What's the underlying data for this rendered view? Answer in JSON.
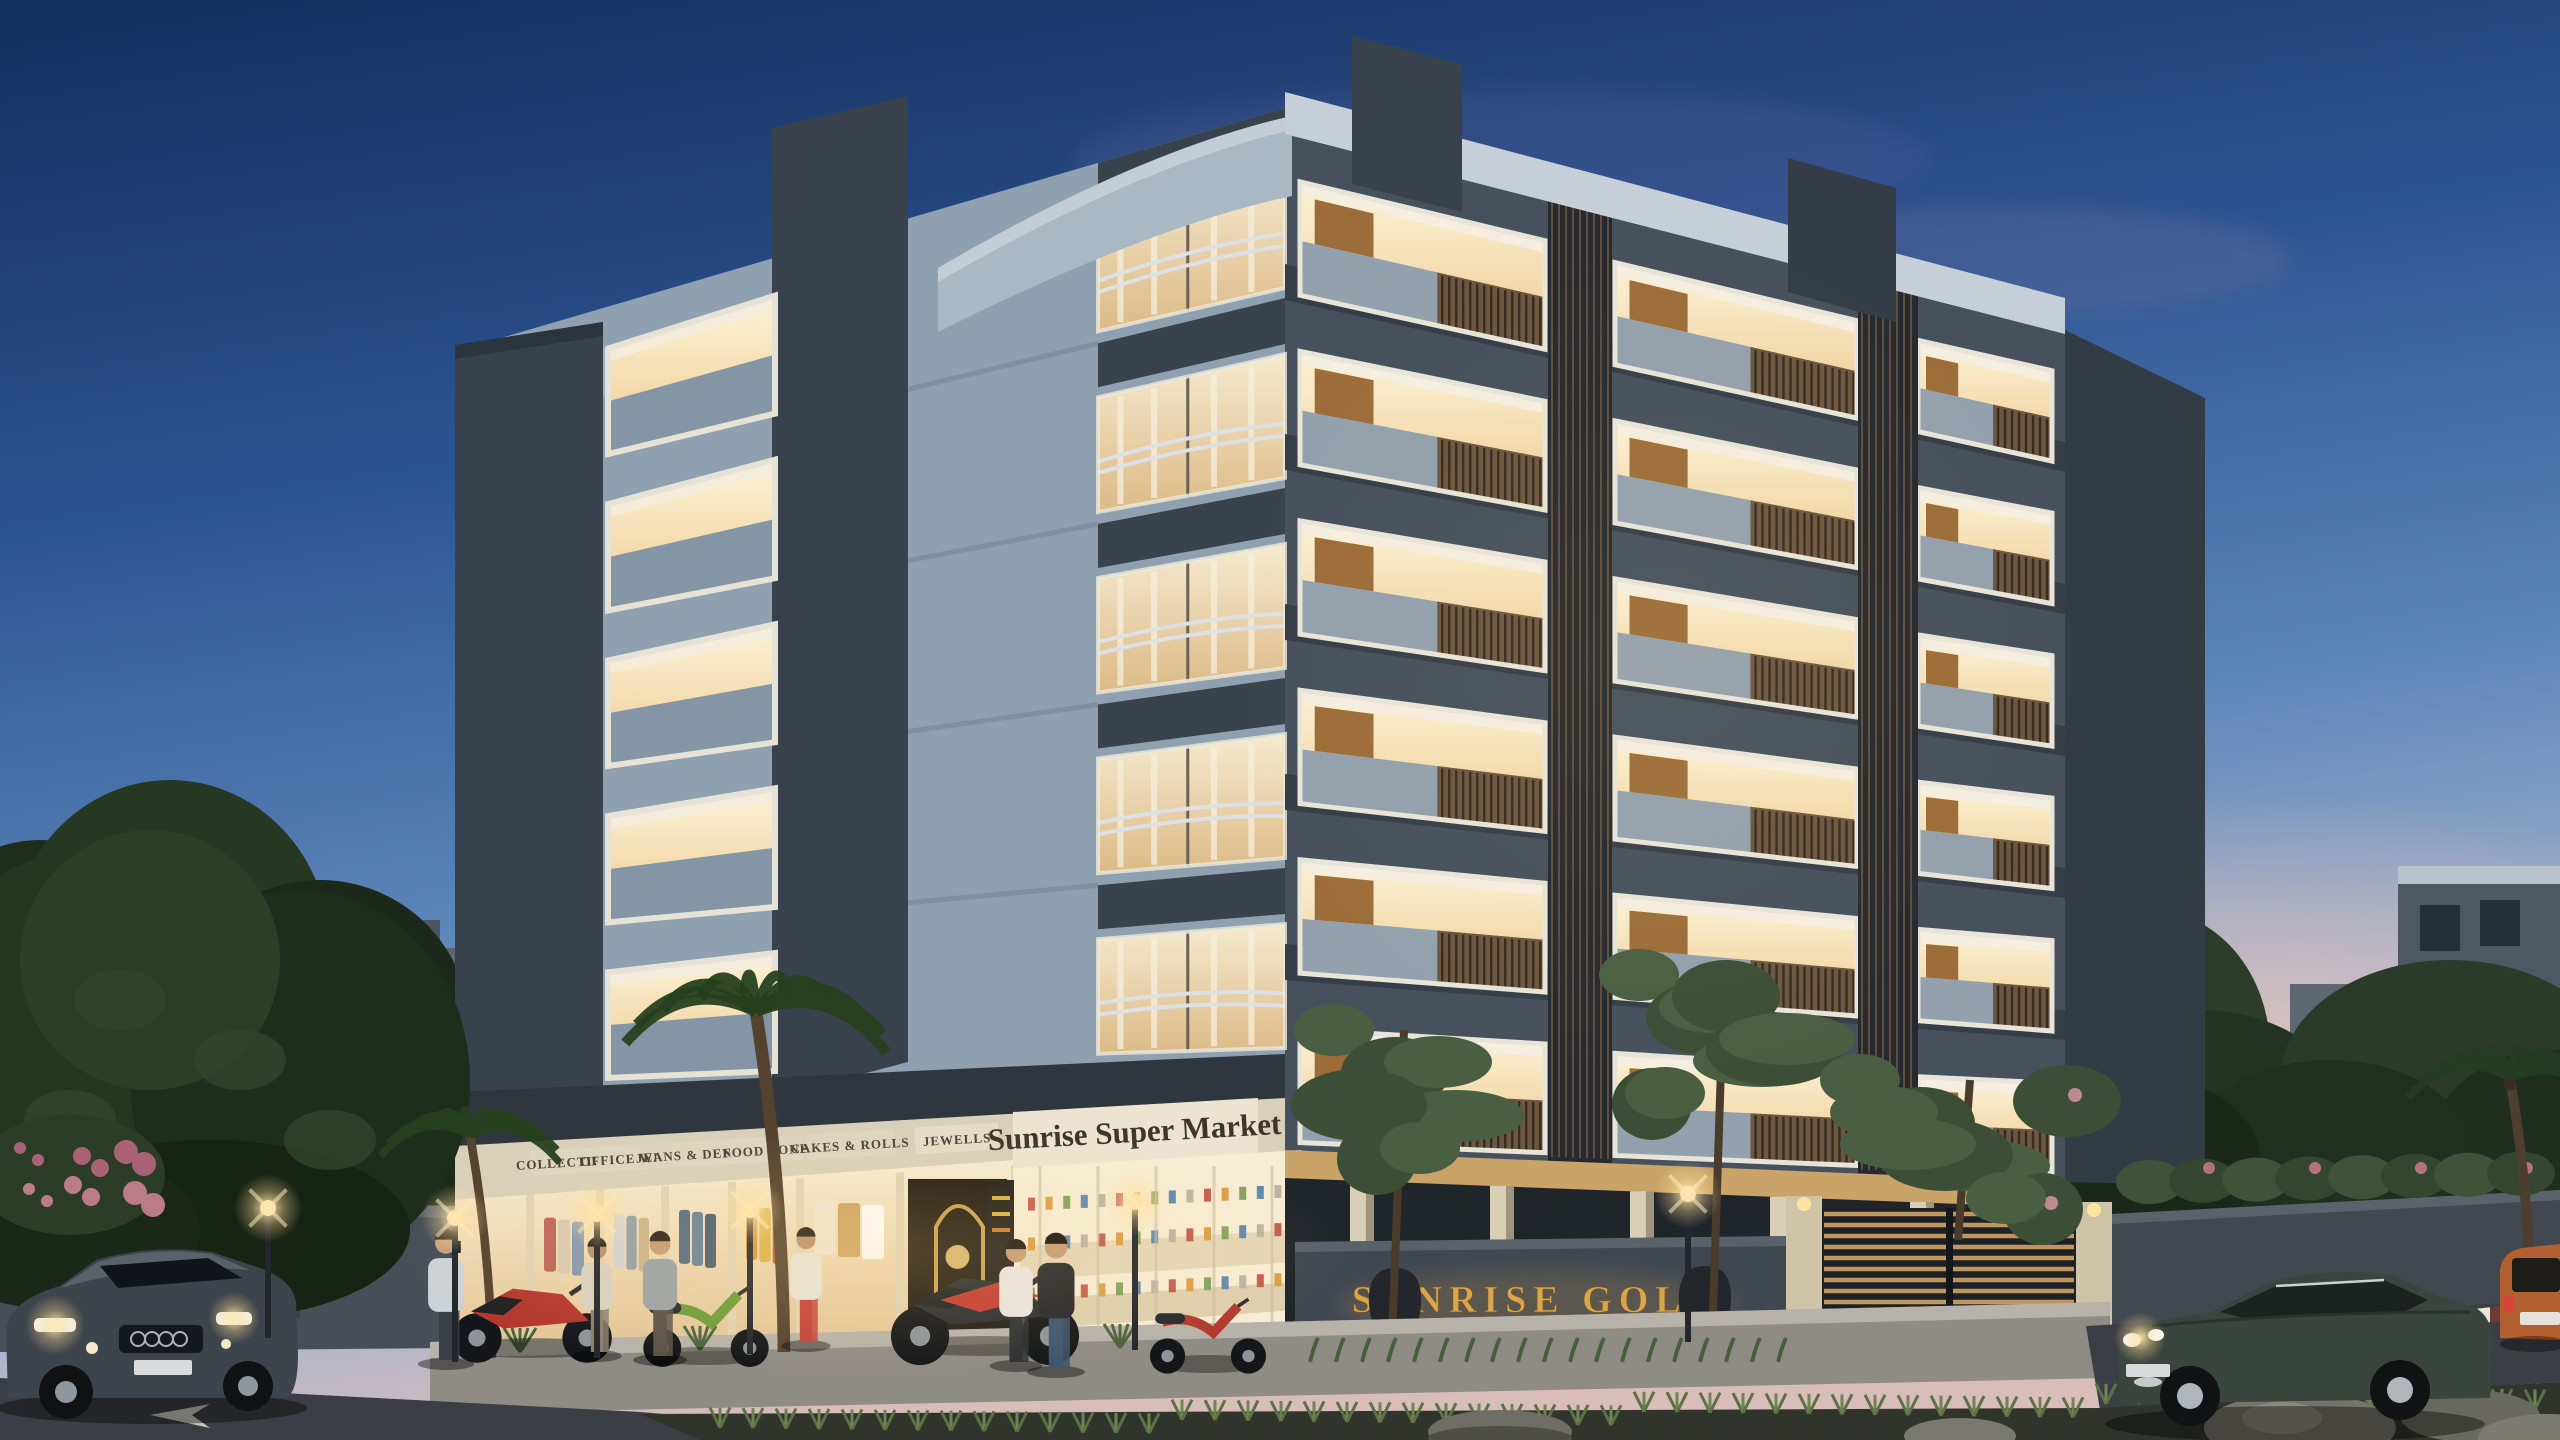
{
  "scene": {
    "type": "3D architectural rendering at dusk",
    "description": "Five-storey SUNRISE GOLD residential building with curved glazed corner, warmly lit balconies, ground-floor retail shops and supermarket, gated stilt parking, street with cars, parked two-wheelers, pedestrians, palms and landscaped median"
  },
  "signs": {
    "supermarket": "Sunrise Super Market",
    "compound_wall": "SUNRISE GOLD",
    "shops": [
      "COLLECTION",
      "OFFICE WEAR",
      "JEANS & DENIMS",
      "FOOD ZONE",
      "CAKES & ROLLS",
      "JEWELLS"
    ]
  },
  "building": {
    "floors_above_ground": 5,
    "right_face_balcony_bays": 3,
    "left_face_lit_bay_columns": 1,
    "corner": "curved glass corner balconies with thin railings",
    "ground_floor": "retail shops, supermarket, stilt parking behind compound wall and slatted gate"
  },
  "vehicles": {
    "cars": [
      "dark grey sedan with headlights on (left foreground)",
      "dark green sedan with headlights on (right road)",
      "orange SUV seen from rear (far right)",
      "grey van parked behind gate"
    ],
    "two_wheelers": [
      "red sport bike",
      "green scooter",
      "black and red sport bike",
      "red scooter at supermarket"
    ]
  },
  "people": [
    "man on phone near shops",
    "woman window shopping",
    "man standing at shop window",
    "jogger in red shorts",
    "woman walking to supermarket",
    "man in black t-shirt at supermarket"
  ],
  "environment": {
    "time": "dusk",
    "street_lamps_lit": 6,
    "trees": [
      "palm at shopfront",
      "small palm left",
      "palm far right",
      "slender trees at right facade",
      "flowering tree over gate",
      "dense dark trees left and right"
    ],
    "road_markings": [
      "white arrow on left road",
      "hazard-striped kerbs"
    ],
    "median": "grass tufts with grey boulders"
  },
  "palette": {
    "sky_top": "#16305c",
    "sky_mid": "#4976b1",
    "sky_horizon_pink": "#e3c2ba",
    "facade_light": "#97a6b4",
    "facade_dark": "#39424c",
    "balcony_glow": "#f6e7c4",
    "wood": "#8a6f4d",
    "sign_gold": "#d7a64d",
    "fascia_cream": "#e9e0cc",
    "road": "#3a3d43",
    "greenery": "#2e4026"
  }
}
